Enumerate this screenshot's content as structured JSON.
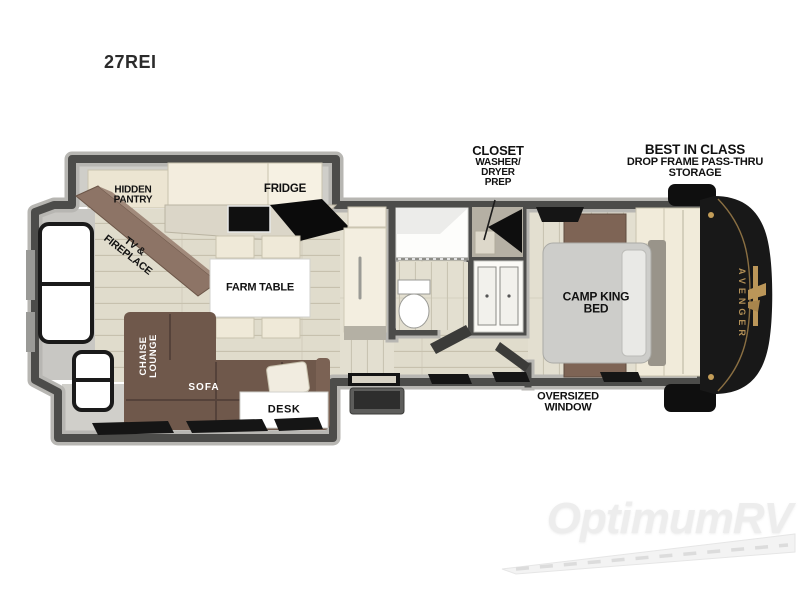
{
  "title": "27REI",
  "floorplan": {
    "brand_badge": "AVENGER",
    "callouts": {
      "closet": {
        "title": "CLOSET",
        "sub1": "WASHER/",
        "sub2": "DRYER",
        "sub3": "PREP"
      },
      "best_in_class": {
        "title": "BEST IN CLASS",
        "sub1": "DROP FRAME PASS-THRU",
        "sub2": "STORAGE"
      },
      "oversized_window": "OVERSIZED WINDOW"
    },
    "labels": {
      "hidden_pantry": "HIDDEN PANTRY",
      "fridge": "FRIDGE",
      "tv_fireplace": "TV & FIREPLACE",
      "farm_table": "FARM TABLE",
      "chaise_lounge": "CHAISE LOUNGE",
      "sofa": "SOFA",
      "desk": "DESK",
      "camp_king_bed": "CAMP KING BED"
    },
    "colors": {
      "wall": "#4c4c4a",
      "floor_plank": "#e0dccc",
      "slideout_floor": "#d0cfca",
      "furniture_brown": "#6f584b",
      "cabinet_cream": "#f1ebda",
      "front_cap": "#181818",
      "brand_gold": "#b49157"
    }
  },
  "watermark": {
    "text": "OptimumRV"
  }
}
